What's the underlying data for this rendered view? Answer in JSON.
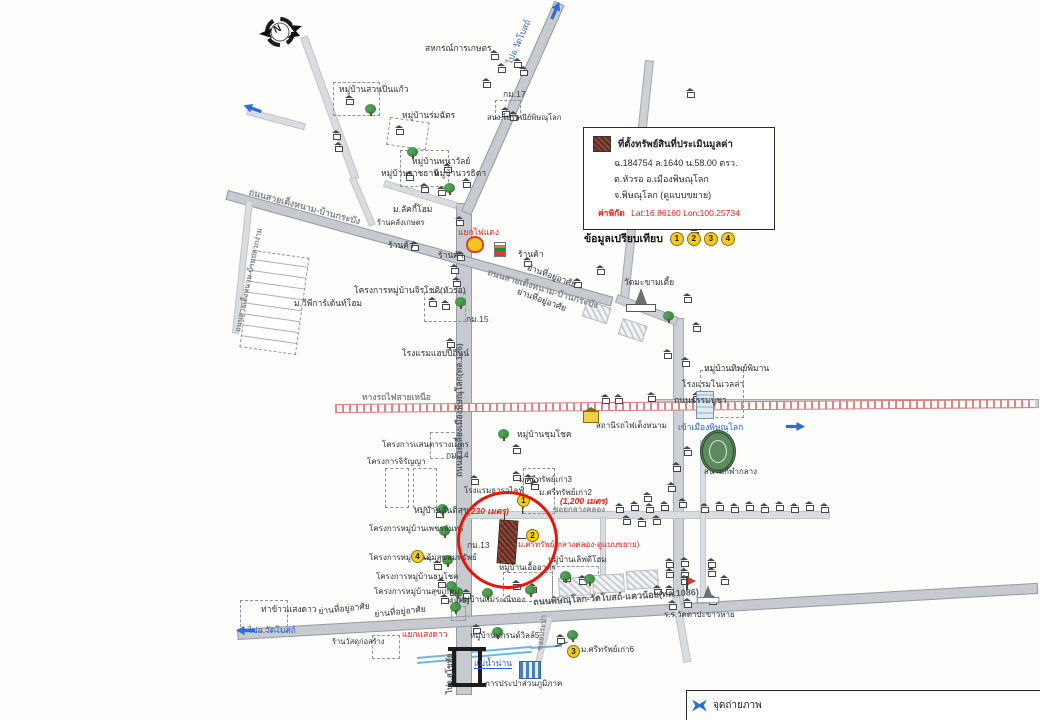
{
  "legend": {
    "title": "ที่ตั้งทรัพย์สินที่ประเมินมูลค่า",
    "line1": "ฉ.184754  ล.1640  น.58.00 ตรว.",
    "line2": "ต.หัวรอ อ.เมืองพิษณุโลก",
    "line3": "จ.พิษณุโลก  (ดูแบบขยาย)",
    "coords_label": "ค่าพิกัด",
    "coords_value": "Lat:16.86160  Lon:100.25734"
  },
  "comparison": {
    "label": "ข้อมูลเปรียบเทียบ",
    "numbers": [
      "1",
      "2",
      "3",
      "4"
    ]
  },
  "compass": {
    "letter": "N"
  },
  "photo_box": {
    "label": "จุดถ่ายภาพ"
  },
  "colors": {
    "highlight_red": "#e8150a",
    "label_red": "#e0261c",
    "map_blue": "#2a6fd6",
    "marker_yellow": "#f2cb1d",
    "property_brown": "#7c4033",
    "road_grey": "#cdd1d5",
    "rail_red": "#dd8585"
  },
  "map": {
    "roads": [
      {
        "x": 456,
        "y": 203,
        "w": 14,
        "h": 490,
        "cls": "major"
      },
      {
        "x": 461,
        "y": 211,
        "w": 228,
        "h": 9,
        "rot": -66,
        "cls": "major"
      },
      {
        "x": 228,
        "y": 190,
        "w": 398,
        "h": 8,
        "rot": 15.5,
        "cls": "major"
      },
      {
        "x": 645,
        "y": 60,
        "w": 7,
        "h": 240,
        "rot": 6
      },
      {
        "x": 673,
        "y": 318,
        "w": 9,
        "h": 296
      },
      {
        "x": 655,
        "y": 399,
        "w": 382,
        "h": 7
      },
      {
        "x": 237,
        "y": 629,
        "w": 800,
        "h": 9,
        "rot": -3.3,
        "cls": "major"
      },
      {
        "x": 466,
        "y": 511,
        "w": 362,
        "h": 6,
        "cls": "minor"
      },
      {
        "x": 600,
        "y": 517,
        "w": 4,
        "h": 62,
        "cls": "minor"
      },
      {
        "x": 547,
        "y": 616,
        "w": 4,
        "h": 48,
        "rot": 14.5,
        "cls": "minor"
      },
      {
        "x": 300,
        "y": 38,
        "w": 6,
        "h": 150,
        "rot": -20,
        "cls": "minor"
      },
      {
        "x": 349,
        "y": 179,
        "w": 5,
        "h": 50,
        "rot": -23,
        "cls": "minor"
      },
      {
        "x": 385,
        "y": 180,
        "w": 74,
        "h": 5,
        "rot": 17,
        "cls": "minor"
      },
      {
        "x": 246,
        "y": 200,
        "w": 5,
        "h": 132,
        "rot": 6,
        "cls": "minor"
      },
      {
        "x": 672,
        "y": 598,
        "w": 6,
        "h": 64,
        "rot": -10,
        "cls": "minor"
      },
      {
        "x": 700,
        "y": 440,
        "w": 4,
        "h": 162,
        "cls": "minor"
      },
      {
        "x": 248,
        "y": 108,
        "w": 58,
        "h": 5,
        "rot": 15,
        "cls": "minor"
      },
      {
        "x": 618,
        "y": 294,
        "w": 63,
        "h": 7,
        "rot": 21
      }
    ],
    "railway": {
      "x": 335,
      "y": 404,
      "w": 700,
      "h": 7,
      "rot": -0.4
    },
    "water": [
      {
        "x": 417,
        "y": 657,
        "w": 37,
        "rot": -5
      },
      {
        "x": 417,
        "y": 662,
        "w": 37,
        "rot": -5
      },
      {
        "x": 472,
        "y": 651,
        "w": 60,
        "rot": -5
      },
      {
        "x": 472,
        "y": 656,
        "w": 60,
        "rot": -5
      },
      {
        "x": 530,
        "y": 647,
        "w": 32,
        "rot": -4
      }
    ],
    "dashed_boxes": [
      {
        "x": 333,
        "y": 82,
        "w": 45,
        "h": 32
      },
      {
        "x": 390,
        "y": 117,
        "w": 38,
        "h": 26,
        "rot": 8
      },
      {
        "x": 400,
        "y": 150,
        "w": 47,
        "h": 35
      },
      {
        "x": 424,
        "y": 292,
        "w": 40,
        "h": 28
      },
      {
        "x": 430,
        "y": 432,
        "w": 28,
        "h": 25
      },
      {
        "x": 385,
        "y": 468,
        "w": 22,
        "h": 38
      },
      {
        "x": 413,
        "y": 468,
        "w": 22,
        "h": 38
      },
      {
        "x": 523,
        "y": 468,
        "w": 30,
        "h": 44
      },
      {
        "x": 503,
        "y": 572,
        "w": 48,
        "h": 28
      },
      {
        "x": 552,
        "y": 566,
        "w": 45,
        "h": 30
      },
      {
        "x": 240,
        "y": 600,
        "w": 46,
        "h": 30
      },
      {
        "x": 372,
        "y": 635,
        "w": 26,
        "h": 22
      },
      {
        "x": 700,
        "y": 370,
        "w": 42,
        "h": 46
      },
      {
        "x": 451,
        "y": 606,
        "w": 13,
        "h": 13
      },
      {
        "x": 495,
        "y": 100,
        "w": 24,
        "h": 16
      }
    ],
    "hatch_blocks": [
      {
        "x": 587,
        "y": 300,
        "w": 24,
        "h": 15,
        "rot": 18
      },
      {
        "x": 623,
        "y": 318,
        "w": 24,
        "h": 15,
        "rot": 18
      },
      {
        "x": 558,
        "y": 578,
        "w": 30,
        "h": 17,
        "rot": -3
      },
      {
        "x": 592,
        "y": 575,
        "w": 30,
        "h": 17,
        "rot": -3
      },
      {
        "x": 626,
        "y": 571,
        "w": 30,
        "h": 17,
        "rot": -3
      },
      {
        "x": 253,
        "y": 250,
        "w": 55,
        "h": 96,
        "rot": 8,
        "grid": 1
      }
    ],
    "lines": [
      {
        "x": 523,
        "y": 506,
        "len": 8,
        "rot": 90
      },
      {
        "x": 513,
        "y": 538,
        "len": 13,
        "rot": 0
      },
      {
        "x": 555,
        "y": 646,
        "len": 13,
        "rot": -20
      },
      {
        "x": 421,
        "y": 557,
        "len": 11,
        "rot": 12
      },
      {
        "x": 505,
        "y": 513,
        "len": 8,
        "rot": 90
      }
    ],
    "houses": [
      [
        490,
        50
      ],
      [
        513,
        58
      ],
      [
        497,
        63
      ],
      [
        519,
        66
      ],
      [
        482,
        78
      ],
      [
        332,
        130
      ],
      [
        334,
        142
      ],
      [
        345,
        95
      ],
      [
        405,
        171
      ],
      [
        420,
        183
      ],
      [
        437,
        186
      ],
      [
        443,
        163
      ],
      [
        462,
        178
      ],
      [
        395,
        125
      ],
      [
        455,
        216
      ],
      [
        410,
        241
      ],
      [
        456,
        251
      ],
      [
        523,
        257
      ],
      [
        450,
        264
      ],
      [
        452,
        277
      ],
      [
        573,
        278
      ],
      [
        596,
        265
      ],
      [
        686,
        88
      ],
      [
        692,
        148
      ],
      [
        684,
        183
      ],
      [
        690,
        228
      ],
      [
        683,
        293
      ],
      [
        692,
        322
      ],
      [
        663,
        349
      ],
      [
        681,
        357
      ],
      [
        601,
        394
      ],
      [
        614,
        394
      ],
      [
        647,
        392
      ],
      [
        692,
        392
      ],
      [
        704,
        392
      ],
      [
        683,
        446
      ],
      [
        672,
        462
      ],
      [
        667,
        482
      ],
      [
        678,
        498
      ],
      [
        643,
        492
      ],
      [
        512,
        444
      ],
      [
        501,
        107
      ],
      [
        509,
        111
      ],
      [
        428,
        297
      ],
      [
        441,
        300
      ],
      [
        446,
        338
      ],
      [
        512,
        471
      ],
      [
        524,
        474
      ],
      [
        530,
        480
      ],
      [
        470,
        475
      ],
      [
        435,
        508
      ],
      [
        433,
        560
      ],
      [
        437,
        578
      ],
      [
        440,
        594
      ],
      [
        449,
        586
      ],
      [
        462,
        589
      ],
      [
        512,
        580
      ],
      [
        528,
        583
      ],
      [
        562,
        572
      ],
      [
        578,
        575
      ],
      [
        472,
        624
      ],
      [
        556,
        634
      ],
      [
        615,
        503
      ],
      [
        630,
        501
      ],
      [
        645,
        503
      ],
      [
        660,
        501
      ],
      [
        700,
        503
      ],
      [
        715,
        501
      ],
      [
        730,
        503
      ],
      [
        745,
        501
      ],
      [
        760,
        503
      ],
      [
        775,
        501
      ],
      [
        790,
        503
      ],
      [
        805,
        501
      ],
      [
        820,
        503
      ],
      [
        622,
        515
      ],
      [
        637,
        517
      ],
      [
        652,
        515
      ],
      [
        665,
        558
      ],
      [
        680,
        557
      ],
      [
        707,
        558
      ],
      [
        665,
        568
      ],
      [
        680,
        568
      ],
      [
        707,
        567
      ],
      [
        720,
        575
      ],
      [
        653,
        585
      ],
      [
        665,
        585
      ],
      [
        680,
        575
      ],
      [
        668,
        600
      ],
      [
        683,
        598
      ],
      [
        708,
        595
      ]
    ],
    "trees": [
      [
        365,
        104
      ],
      [
        407,
        147
      ],
      [
        444,
        183
      ],
      [
        455,
        297
      ],
      [
        498,
        429
      ],
      [
        663,
        311
      ],
      [
        437,
        504
      ],
      [
        439,
        526
      ],
      [
        442,
        555
      ],
      [
        446,
        581
      ],
      [
        450,
        602
      ],
      [
        567,
        630
      ],
      [
        492,
        627
      ],
      [
        452,
        587
      ],
      [
        482,
        588
      ],
      [
        525,
        585
      ],
      [
        560,
        571
      ],
      [
        584,
        574
      ]
    ],
    "icons": [
      {
        "type": "shell",
        "x": 466,
        "y": 236
      },
      {
        "type": "seven",
        "x": 494,
        "y": 242
      },
      {
        "type": "arrow",
        "x": 546,
        "y": 6,
        "rot": -66
      },
      {
        "type": "arrow",
        "x": 786,
        "y": 422
      },
      {
        "type": "arrow",
        "x": 236,
        "y": 626,
        "rot": 180
      },
      {
        "type": "arrow",
        "x": 243,
        "y": 104,
        "rot": -160
      },
      {
        "type": "temple",
        "x": 626,
        "y": 288
      },
      {
        "type": "temple",
        "x": 693,
        "y": 582,
        "s": 0.75
      },
      {
        "type": "flag",
        "x": 686,
        "y": 576
      },
      {
        "type": "stadium",
        "x": 700,
        "y": 430
      },
      {
        "type": "station",
        "x": 583,
        "y": 411
      },
      {
        "type": "pwa",
        "x": 519,
        "y": 661
      },
      {
        "type": "bridge",
        "x": 452,
        "y": 649
      },
      {
        "type": "bld",
        "x": 696,
        "y": 391
      }
    ],
    "markers": [
      {
        "n": "1",
        "x": 517,
        "y": 494
      },
      {
        "n": "2",
        "x": 526,
        "y": 529
      },
      {
        "n": "3",
        "x": 567,
        "y": 645
      },
      {
        "n": "4",
        "x": 411,
        "y": 550
      }
    ],
    "labels": [
      {
        "t": "สหกรณ์การเกษตร",
        "x": 425,
        "y": 44
      },
      {
        "t": "กม.17",
        "x": 503,
        "y": 90,
        "c": "km"
      },
      {
        "t": "สนง.ไปรษณีย์พิษณุโลก",
        "x": 487,
        "y": 114,
        "fs": 7.5
      },
      {
        "t": "หมู่บ้านสวนปิ่นแก้ว",
        "x": 339,
        "y": 85
      },
      {
        "t": "หมู่บ้านร่มฉัตร",
        "x": 402,
        "y": 111
      },
      {
        "t": "หมู่บ้านพนาวัลย์",
        "x": 412,
        "y": 157
      },
      {
        "t": "หมู่บ้านราชธานี",
        "x": 381,
        "y": 169
      },
      {
        "t": "หมู่บ้านวรธิดา",
        "x": 434,
        "y": 169
      },
      {
        "t": "ม.ลัคกี้โฮม",
        "x": 393,
        "y": 205
      },
      {
        "t": "ร้านคลังเกษตร",
        "x": 377,
        "y": 219,
        "fs": 7.5
      },
      {
        "t": "ร้านค้า",
        "x": 388,
        "y": 241
      },
      {
        "t": "ร้านค้า",
        "x": 438,
        "y": 251
      },
      {
        "t": "ร้านค้า",
        "x": 518,
        "y": 250
      },
      {
        "t": "แยกไฟแดง",
        "x": 458,
        "y": 228,
        "c": "red"
      },
      {
        "t": "ย่านที่อยู่อาศัย",
        "x": 529,
        "y": 263,
        "rot": 20
      },
      {
        "t": "ย่านที่อยู่อาศัย",
        "x": 519,
        "y": 287,
        "rot": 20
      },
      {
        "t": "ม.วีพีการ์เด้นท์โฮม",
        "x": 294,
        "y": 299
      },
      {
        "t": "โครงการหมู่บ้านจิรโชติ(หัวรอ)",
        "x": 354,
        "y": 286
      },
      {
        "t": "โรงแรมแฮปปี้อินน์",
        "x": 402,
        "y": 349
      },
      {
        "t": "วัดมะขามเตี้ย",
        "x": 624,
        "y": 278,
        "n": "temple-label"
      },
      {
        "t": "สถานีรถไฟเต็งหนาม",
        "x": 596,
        "y": 422,
        "fs": 8,
        "n": "railway-station-label"
      },
      {
        "t": "หมู่บ้านชุมโชค",
        "x": 517,
        "y": 430
      },
      {
        "t": "โครงการแสนตารางเมตร",
        "x": 382,
        "y": 441,
        "fs": 8
      },
      {
        "t": "กม.14",
        "x": 446,
        "y": 451,
        "c": "km"
      },
      {
        "t": "โครงการจิรัญญา",
        "x": 367,
        "y": 458,
        "fs": 8
      },
      {
        "t": "ม.ศรีทรัพย์เก่า3",
        "x": 519,
        "y": 476,
        "fs": 8
      },
      {
        "t": "ม.ศรีทรัพย์เก่า2",
        "x": 539,
        "y": 489,
        "fs": 8
      },
      {
        "t": "โรงแรมธาราไลฟ์",
        "x": 464,
        "y": 487,
        "fs": 8
      },
      {
        "t": "หมู่บ้านสันติสุข",
        "x": 414,
        "y": 506
      },
      {
        "t": "กม.13",
        "x": 467,
        "y": 541,
        "c": "km"
      },
      {
        "t": "โครงการหมู่บ้านเพชรจันทร์",
        "x": 369,
        "y": 525,
        "fs": 8
      },
      {
        "t": "โครงการหมู่บ้านคุ้มสุขสมทรัพย์",
        "x": 369,
        "y": 554,
        "fs": 8
      },
      {
        "t": "โครงการหมู่บ้านธนโชค",
        "x": 376,
        "y": 573,
        "fs": 8
      },
      {
        "t": "โครงการหมู่บ้านสุขเกษม",
        "x": 374,
        "y": 588,
        "fs": 8
      },
      {
        "t": "คันเข้า",
        "x": 449,
        "y": 598,
        "fs": 7
      },
      {
        "t": "หมู่บ้านเอื้ออาทร",
        "x": 499,
        "y": 564,
        "fs": 8
      },
      {
        "t": "หมู่บ้านเลิฟดีโฮม",
        "x": 548,
        "y": 556,
        "fs": 8
      },
      {
        "t": "หมู่บ้านแม่ระณีทอง",
        "x": 459,
        "y": 596,
        "fs": 8
      },
      {
        "t": "ย่านที่อยู่อาศัย",
        "x": 374,
        "y": 610,
        "rot": -6
      },
      {
        "t": "ร.ร.วัดตาปะขาวหาย",
        "x": 664,
        "y": 611,
        "fs": 8,
        "n": "school-label"
      },
      {
        "t": "ท่าข้าวแสงดาว",
        "x": 261,
        "y": 605
      },
      {
        "t": "ย่านที่อยู่อาศัย",
        "x": 318,
        "y": 607,
        "rot": -6
      },
      {
        "t": "ร้านวัสดุก่อสร้าง",
        "x": 332,
        "y": 638,
        "fs": 7.5
      },
      {
        "t": "หมู่บ้านแกรนด์วิลล์5",
        "x": 470,
        "y": 632,
        "fs": 8
      },
      {
        "t": "การประปาส่วนภูมิภาค",
        "x": 485,
        "y": 680,
        "fs": 8,
        "n": "waterworks-label"
      },
      {
        "t": "ม.ศรีทรัพย์เก่า6",
        "x": 581,
        "y": 646,
        "fs": 8
      },
      {
        "t": "หมู่บ้านทิพย์พิมาน",
        "x": 704,
        "y": 364
      },
      {
        "t": "โรงแรมโนเวลล่า",
        "x": 682,
        "y": 380
      },
      {
        "t": "สนามกีฬากลาง",
        "x": 704,
        "y": 468,
        "fs": 8,
        "n": "stadium-label"
      },
      {
        "t": "กม.15",
        "x": 466,
        "y": 315,
        "c": "km"
      },
      {
        "t": "ถนนสายเต็งหนาม-บ้านกระบัง",
        "x": 250,
        "y": 188,
        "c": "road",
        "rot": 15,
        "fs": 9
      },
      {
        "t": "ถนนสายเต็งหนาม-บ้านกระบัง",
        "x": 489,
        "y": 268,
        "c": "road",
        "rot": 17,
        "fs": 9
      },
      {
        "t": "ถนนสายเลี่ยงเมืองพิษณุโลก(ทล.126)",
        "x": 455,
        "y": 477,
        "c": "roadDark",
        "rot": -90,
        "fs": 8.5
      },
      {
        "t": "ถนนสายเต็งหนาม-บ้านปลวกง่าม",
        "x": 234,
        "y": 331,
        "c": "road",
        "rot": -78,
        "fs": 7.5
      },
      {
        "t": "ทางรถไฟสายเหนือ",
        "x": 362,
        "y": 393,
        "c": "road",
        "n": "railway-label"
      },
      {
        "t": "ถนนธรรมบูชา",
        "x": 674,
        "y": 396,
        "c": "roadDark"
      },
      {
        "t": "ถนนพิษณุโลก-วัดโบสถ์-แควน้อย(ทล.1086)",
        "x": 533,
        "y": 598,
        "c": "roadDark",
        "rot": -3.5,
        "fs": 9
      },
      {
        "t": "ซอยกลางคลอง",
        "x": 553,
        "y": 506,
        "c": "road",
        "fs": 8
      },
      {
        "t": "ซอยประปา",
        "x": 536,
        "y": 650,
        "c": "road",
        "rot": -83,
        "fs": 7.5
      },
      {
        "t": "ไปจ.สุโขทัย",
        "x": 446,
        "y": 694,
        "c": "roadDark",
        "rot": -90,
        "fs": 8,
        "n": "direction-label"
      },
      {
        "t": "ไปอ.วัดโบสถ์",
        "x": 505,
        "y": 62,
        "c": "blue",
        "rot": -66
      },
      {
        "t": "ไปอ.วัดโบสถ์",
        "x": 248,
        "y": 626,
        "c": "blue"
      },
      {
        "t": "เข้าเมืองพิษณุโลก",
        "x": 678,
        "y": 423,
        "c": "blue"
      },
      {
        "t": "แม่น้ำน่าน",
        "x": 474,
        "y": 659,
        "c": "blueUnder",
        "n": "river-label"
      },
      {
        "t": "(1,200 เมตร)",
        "x": 560,
        "y": 497,
        "c": "redIt"
      },
      {
        "t": "(230 เมตร)",
        "x": 468,
        "y": 507,
        "c": "redIt"
      },
      {
        "t": "ม.ศรีทรัพย์(กลางคลอง-ดูแบบขยาย)",
        "x": 518,
        "y": 541,
        "c": "red",
        "fs": 8,
        "n": "subject-project-label"
      },
      {
        "t": "แยกแสงดาว",
        "x": 402,
        "y": 630,
        "c": "red"
      }
    ]
  }
}
